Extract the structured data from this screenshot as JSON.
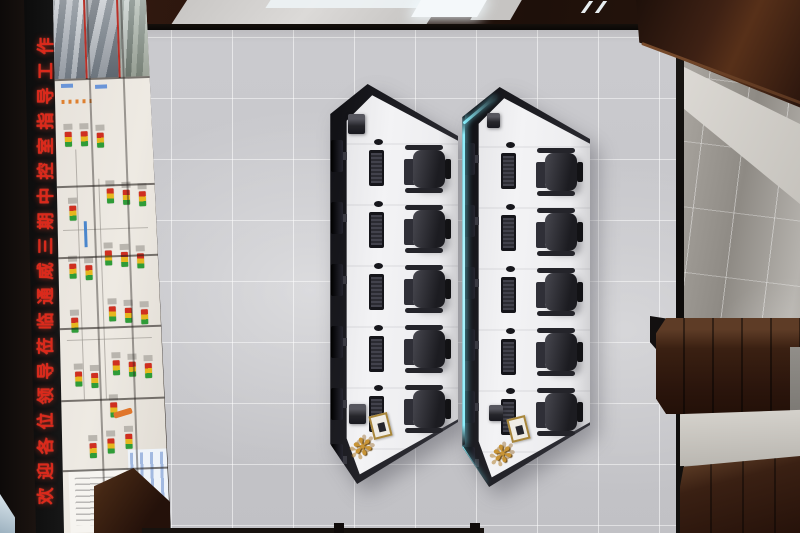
{
  "scene": {
    "type": "3d top-down architectural render",
    "subject": "industrial central control room, overhead plan view"
  },
  "led_banner": {
    "text": "欢迎各位领导莅临通威三期中控室指导工作",
    "text_color": "#db291b",
    "panel_color": "#0a0a0a",
    "orientation": "vertical, reads bottom to top"
  },
  "video_wall": {
    "panel_columns": 3,
    "camera_feeds": 3,
    "feed_seam_color": "#b83028",
    "status_indicator_colors": {
      "alarm_red": "#cf2f20",
      "warn_yellow": "#e6b61e",
      "ok_green": "#2f9c38"
    },
    "accent_orange": "#e0762c",
    "table_blue": "#4a7cc8",
    "background": "#efebe4"
  },
  "consoles": {
    "left": {
      "workstations": 5,
      "monitors": 6,
      "chairs": 5,
      "desk_color": "#efeff1",
      "shell_color": "#1b1b20",
      "accessories": [
        "printer",
        "printer",
        "document-tray",
        "gold-plant"
      ]
    },
    "right": {
      "workstations": 5,
      "monitors": 6,
      "chairs": 5,
      "desk_color": "#efeff1",
      "shell_color": "#1b1b20",
      "edge_light_color": "#8ceefb",
      "accessories": [
        "printer",
        "printer",
        "document-tray",
        "gold-plant"
      ]
    }
  },
  "room": {
    "floor_tile_color": "#c6c6ca",
    "wood_color": "#3a2114",
    "right_wall_color": "#a5a19b",
    "ceiling_light_color": "#f3f7f9"
  },
  "icons": {
    "plant_glyph": "✻"
  }
}
